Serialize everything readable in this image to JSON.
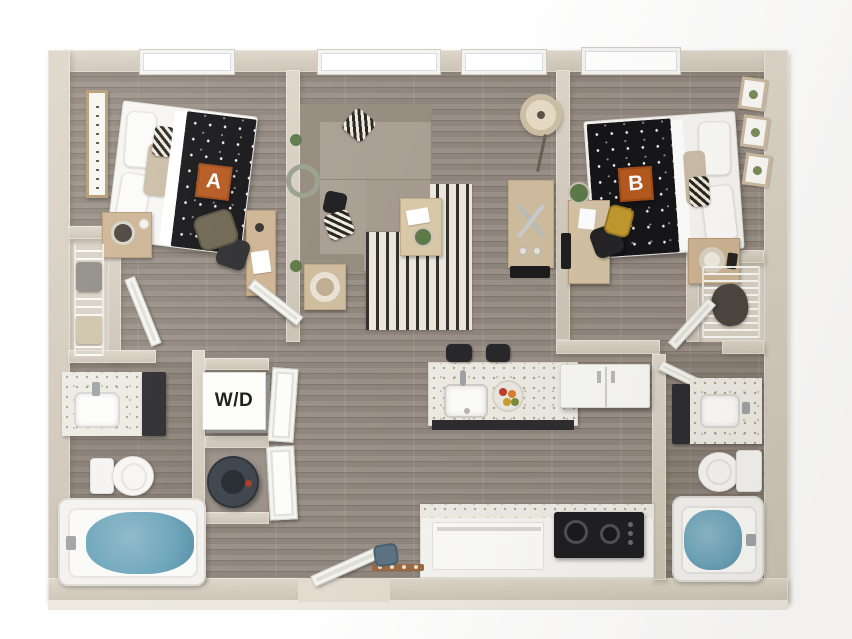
{
  "floorplan": {
    "labels": {
      "bedroom_a": "A",
      "bedroom_b": "B",
      "washer_dryer": "W/D"
    },
    "colors": {
      "wall": "#cbc3b4",
      "wall_light": "#ddd6c9",
      "floor_plank": "#958b82",
      "floor_seam": "#80766d",
      "label_bg": "#b5581e",
      "label_text": "#ffffff",
      "blanket_black": "#141417",
      "sofa_taupe": "#a99f93",
      "rug_ivory": "#ebe7dc",
      "rug_stripe": "#35322d",
      "counter_speckle": "#edebe3",
      "cabinet_charcoal": "#2c2c2f",
      "tub_water": "#6ba4ba",
      "appliance_white": "#f8f8f5",
      "wood_furniture": "#cdb493",
      "plant_green": "#5d7a4a",
      "backpack_yellow": "#c2992e",
      "backpack_olive": "#6d6550",
      "entry_bag_blue": "#5b7384",
      "water_heater": "#3e444c"
    }
  }
}
